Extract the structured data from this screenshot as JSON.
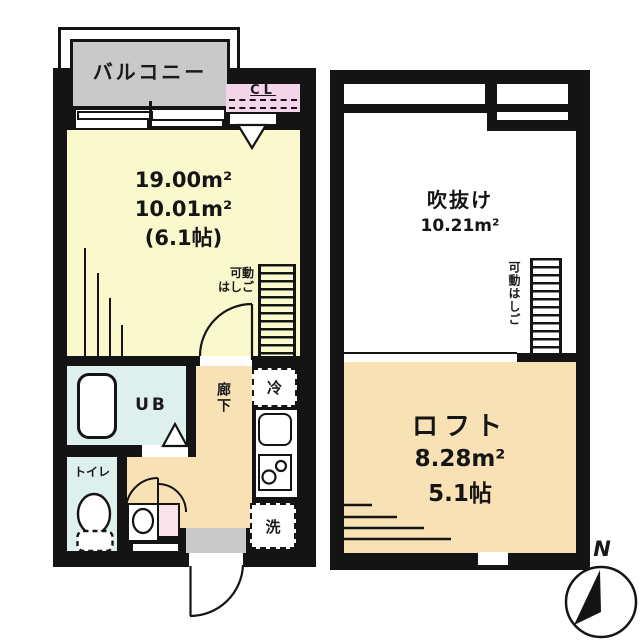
{
  "first_floor": {
    "balcony": "バルコニー",
    "closet": "CL",
    "room_areas": [
      "19.00m²",
      "10.01m²",
      "(6.1帖)"
    ],
    "ladder_line1": "可動",
    "ladder_line2": "はしご",
    "unit_bath": "UB",
    "toilet": "トイレ",
    "hallway": "廊下",
    "fridge": "冷",
    "washer": "洗"
  },
  "loft_floor": {
    "void": "吹抜け",
    "void_area": "10.21m²",
    "ladder": "可動はしご",
    "loft": "ロフト",
    "loft_area": "8.28m²",
    "loft_size": "5.1帖"
  },
  "compass": "N",
  "colors": {
    "room_yellow": "#FAF8CD",
    "tatami_tan": "#F8E2B5",
    "bath_blue": "#DEF0EE",
    "closet_pink": "#F3D4E8",
    "washstand_pink": "#F9E2EA",
    "balcony_gray": "#C9C9C9",
    "wall_black": "#141414"
  }
}
